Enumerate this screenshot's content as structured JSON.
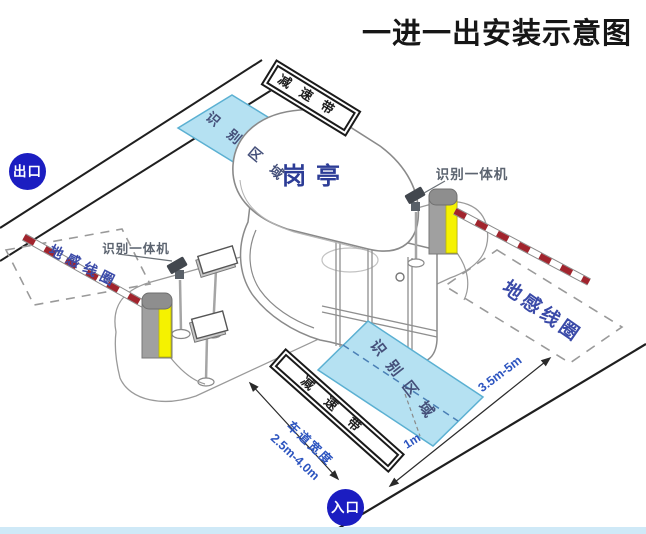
{
  "header": {
    "title": "一进一出安装示意图"
  },
  "badges": {
    "exit": "出口",
    "entrance": "入口"
  },
  "booth": {
    "label": "岗亭"
  },
  "zones": {
    "top": "识别区域",
    "bottom": "识别区域"
  },
  "loops": {
    "left": "地感线圈",
    "right": "地感线圈"
  },
  "cameras": {
    "left": "识别一体机",
    "right": "识别一体机"
  },
  "speed_bumps": {
    "top": "减速带",
    "bottom": "减速带"
  },
  "dimensions": {
    "lane_width_label": "车道宽度",
    "lane_width_value": "2.5m-4.0m",
    "loop_distance": "3.5m-5m",
    "zone_offset": "1m"
  },
  "colors": {
    "label_blue": "#3a4aa8",
    "dimension_blue": "#2d55c0",
    "badge_blue": "#1b1dc1",
    "zone_fill": "#b5e1f2",
    "zone_border": "#5bb0d2",
    "barrier_yellow": "#f5f200",
    "barrier_gray": "#a0a0a0",
    "stripe_red": "#a1242d",
    "road_line": "#1f1f1f",
    "bottom_strip": "#cfe9f7"
  }
}
